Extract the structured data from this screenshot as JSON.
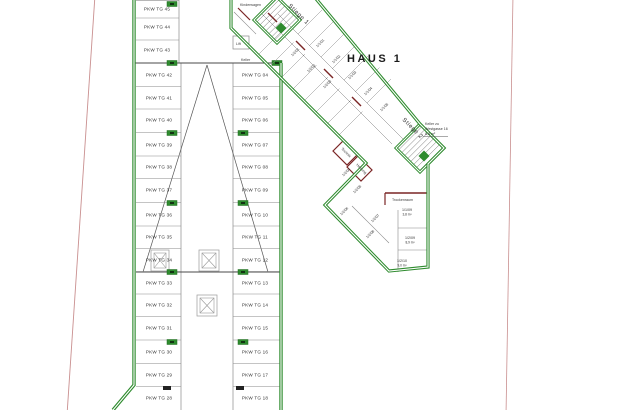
{
  "title": {
    "haus": "HAUS 1"
  },
  "colors": {
    "wall_green": "#2e8b2e",
    "wall_green_dark": "#1f6b1f",
    "boundary_red": "#c98f8f",
    "inner_wall_red": "#7a2525",
    "line_gray": "#8a8a8a",
    "line_dark": "#4a4a4a",
    "text": "#333333"
  },
  "stairs": [
    {
      "label": "Stiege 1",
      "x": 288,
      "y": 6,
      "rot": 45,
      "cx": 277,
      "cy": 20,
      "hd": 23
    },
    {
      "label": "Stiege 2",
      "x": 402,
      "y": 120,
      "rot": 45,
      "cx": 420,
      "cy": 148,
      "hd": 24
    }
  ],
  "parking": {
    "columns": [
      {
        "name": "left-top",
        "label_x": 157,
        "x1": 136,
        "x2": 179,
        "labels": [
          "PKW TG 45",
          "PKW TG 44",
          "PKW TG 43"
        ],
        "ys": [
          9,
          27,
          50
        ]
      },
      {
        "name": "left",
        "label_x": 159,
        "x1": 136,
        "x2": 181,
        "labels": [
          "PKW TG 42",
          "PKW TG 41",
          "PKW TG 40",
          "PKW TG 39",
          "PKW TG 38",
          "PKW TG 37",
          "PKW TG 36",
          "PKW TG 35",
          "PKW TG 34",
          "PKW TG 33",
          "PKW TG 32",
          "PKW TG 31",
          "PKW TG 30",
          "PKW TG 29",
          "PKW TG 28"
        ],
        "ys": [
          75,
          98,
          120,
          145,
          167,
          190,
          215,
          237,
          260,
          283,
          305,
          328,
          352,
          375,
          398
        ]
      },
      {
        "name": "middle",
        "label_x": 255,
        "x1": 233,
        "x2": 280,
        "labels": [
          "PKW TG 04",
          "PKW TG 05",
          "PKW TG 06",
          "PKW TG 07",
          "PKW TG 08",
          "PKW TG 09",
          "PKW TG 10",
          "PKW TG 11",
          "PKW TG 12",
          "PKW TG 13",
          "PKW TG 14",
          "PKW TG 15",
          "PKW TG 16",
          "PKW TG 17",
          "PKW TG 18"
        ],
        "ys": [
          75,
          98,
          120,
          145,
          167,
          190,
          215,
          237,
          260,
          283,
          305,
          328,
          352,
          375,
          398
        ]
      }
    ]
  },
  "rooms": [
    {
      "label": "1/2/01",
      "x": 296,
      "y": 53,
      "rot": -45
    },
    {
      "label": "1/2/02",
      "x": 312,
      "y": 69,
      "rot": -45
    },
    {
      "label": "1/2/03",
      "x": 328,
      "y": 85,
      "rot": -45
    },
    {
      "label": "1/1/01",
      "x": 321,
      "y": 44,
      "rot": -45
    },
    {
      "label": "1/1/02",
      "x": 337,
      "y": 60,
      "rot": -45
    },
    {
      "label": "1/1/03",
      "x": 353,
      "y": 76,
      "rot": -45
    },
    {
      "label": "1/1/04",
      "x": 369,
      "y": 92,
      "rot": -45
    },
    {
      "label": "1/1/05",
      "x": 385,
      "y": 108,
      "rot": -45
    },
    {
      "label": "1/2/04",
      "x": 347,
      "y": 173,
      "rot": -45
    },
    {
      "label": "1/2/05",
      "x": 358,
      "y": 190,
      "rot": -45
    },
    {
      "label": "1/2/06",
      "x": 345,
      "y": 212,
      "rot": -45
    },
    {
      "label": "1/2/07",
      "x": 376,
      "y": 219,
      "rot": -45
    },
    {
      "label": "1/2/08",
      "x": 371,
      "y": 235,
      "rot": -45
    },
    {
      "label": "1/1/09",
      "x": 407,
      "y": 211,
      "rot": 0,
      "area": "3,8 m²"
    },
    {
      "label": "1/2/09",
      "x": 410,
      "y": 239,
      "rot": 0,
      "area": "8,9 m²"
    },
    {
      "label": "1/2/10",
      "x": 402,
      "y": 262,
      "rot": 0,
      "area": "9,0 m²"
    }
  ],
  "service": {
    "technik": {
      "label": "Technik",
      "x": 341,
      "y": 149,
      "rot": 45
    },
    "heizung": {
      "label": "Heizung",
      "x": 356,
      "y": 165,
      "rot": 45
    },
    "trockenraum": {
      "label": "Trockenraum",
      "x": 407,
      "y": 200
    },
    "kinderwagen": {
      "label": "Kinderwagen",
      "x": 252,
      "y": 5
    },
    "keller": {
      "label": "Keller",
      "x": 247,
      "y": 60
    },
    "lift": {
      "label": "Lift",
      "x": 241,
      "y": 45
    }
  },
  "note": {
    "x": 425,
    "y": 125,
    "lines": [
      "Keller zu",
      "Westgasse 16",
      "8,8 m²"
    ]
  }
}
